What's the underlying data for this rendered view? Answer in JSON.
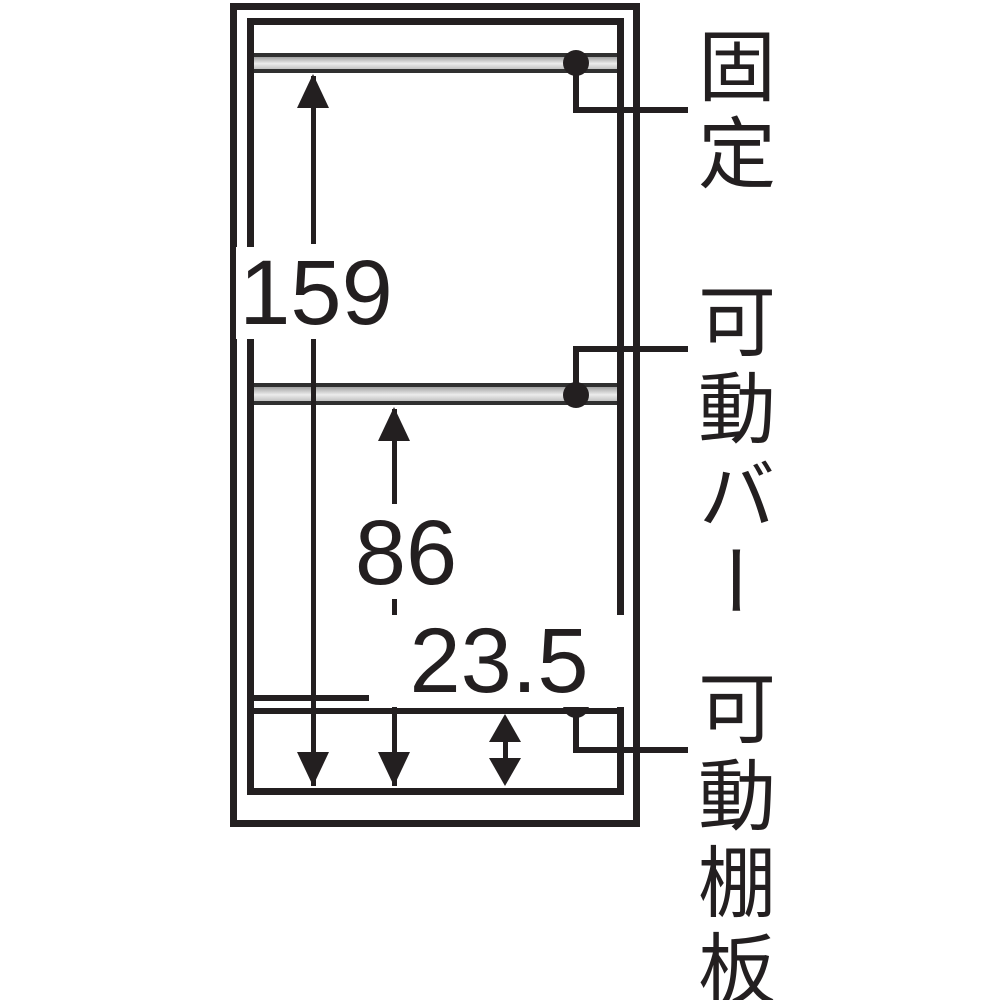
{
  "diagram": {
    "part_labels": {
      "fixed": "固定",
      "movable_bar": "可動バー",
      "movable_shelf_board": "可動棚板"
    },
    "dimension_values": {
      "fixed_bar_to_bottom": "159",
      "movable_bar_to_bottom": "86",
      "shelf_board_to_bottom": "23.5"
    },
    "colors": {
      "line": "#231f20",
      "bar_fill_gray": "#c9c9c9",
      "background": "#ffffff"
    }
  }
}
